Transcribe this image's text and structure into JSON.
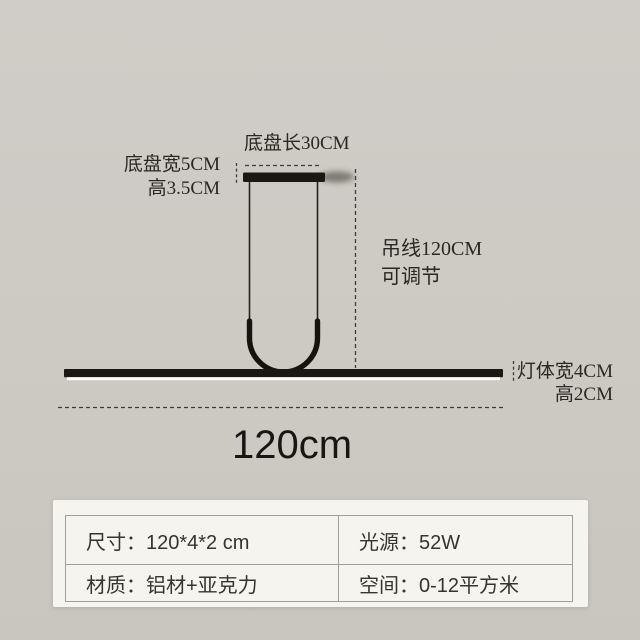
{
  "diagram": {
    "labels": {
      "base_length": "底盘长30CM",
      "base_width": "底盘宽5CM",
      "base_height": "高3.5CM",
      "suspension": "吊线120CM",
      "adjustable": "可调节",
      "body_width": "灯体宽4CM",
      "body_height": "高2CM",
      "overall_length": "120cm"
    },
    "colors": {
      "background": "#cdc9c3",
      "fixture_black": "#1b1814",
      "light_strip_white": "#fdfcf6",
      "dashed_line": "#413c35",
      "annotation_text": "#2b2824"
    }
  },
  "spec_panel": {
    "colors": {
      "panel_background": "#f6f4ef",
      "table_border": "#a39e97",
      "text": "#37332e"
    },
    "cells": {
      "size": "尺寸：120*4*2 cm",
      "power": "光源：52W",
      "material": "材质：铝材+亚克力",
      "space": "空间：0-12平方米"
    }
  }
}
